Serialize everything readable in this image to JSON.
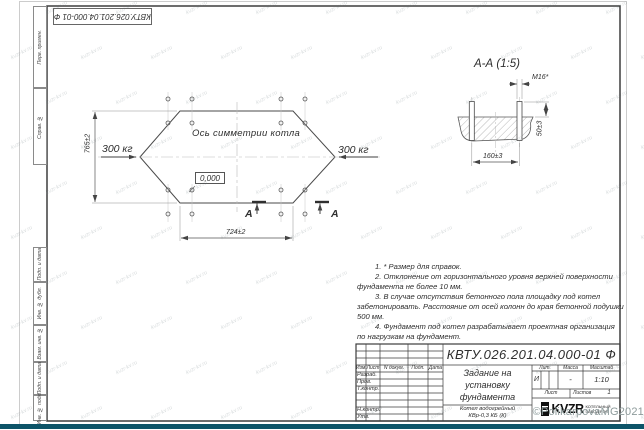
{
  "sheet": {
    "top_stamp": "КВТУ.026.201.04.000-01 Ф",
    "side_labels": [
      "Перв. примен.",
      "Справ. №",
      "Подп. и дата",
      "Инв. № дубл.",
      "Взам. инв. №",
      "Подп. и дата",
      "Инв. № подл."
    ]
  },
  "plan": {
    "axis_label": "Ось симметрии котла",
    "load_left": "300 кг",
    "load_right": "300 кг",
    "elevation_mark": "0,000",
    "dim_vertical": "765±2",
    "dim_horizontal": "724±2",
    "section_letter": "А"
  },
  "section_view": {
    "title": "А-А (1:5)",
    "thread_label": "М16*",
    "dim_protrusion": "50±3",
    "dim_spacing": "160±3"
  },
  "notes": [
    "1. * Размер для справок.",
    "2. Отклонение от горизонтального уровня верхней поверхности",
    "фундамента не более 10 мм.",
    "3. В случае отсутствия бетонного пола площадку под котел",
    "забетонировать. Расстояние от осей колонн до края бетонной подушки",
    "500 мм.",
    "4. Фундамент под котел разрабатывает проектная организация",
    "по нагрузкам на фундамент."
  ],
  "title_block": {
    "designation": "КВТУ.026.201.04.000-01 Ф",
    "doc_title_line1": "Задание на",
    "doc_title_line2": "установку",
    "doc_title_line3": "фундамента",
    "product_line1": "Котел водогрейный",
    "product_line2": "КВр-0,3 КБ (К)",
    "col_izm": "Изм.",
    "col_list": "Лист",
    "col_doc": "N докум.",
    "col_podp": "Подп.",
    "col_data": "Дата",
    "row_razrab": "Разраб.",
    "row_prov": "Пров.",
    "row_tkontr": "Т.контр.",
    "row_nkontr": "Н.контр.",
    "row_utv": "Утв.",
    "lit_label": "Лит.",
    "lit_value": "И",
    "mass_label": "Масса",
    "mass_value": "-",
    "scale_label": "Масштаб",
    "scale_value": "1:10",
    "sheet_label": "Лист",
    "sheets_label": "Листов",
    "sheets_value": "1",
    "logo_text": "KVZR",
    "logo_sub_line1": "КОТЕЛЬНЫЙ",
    "logo_sub_line2": "ЗАВОД РЭП"
  },
  "watermark": {
    "tile_text": "kvzr-kv.ru",
    "copyright": "©PolikarpovaMG2021"
  },
  "colors": {
    "line": "#3f3f3f",
    "bottom_bar": "#0d5468"
  }
}
